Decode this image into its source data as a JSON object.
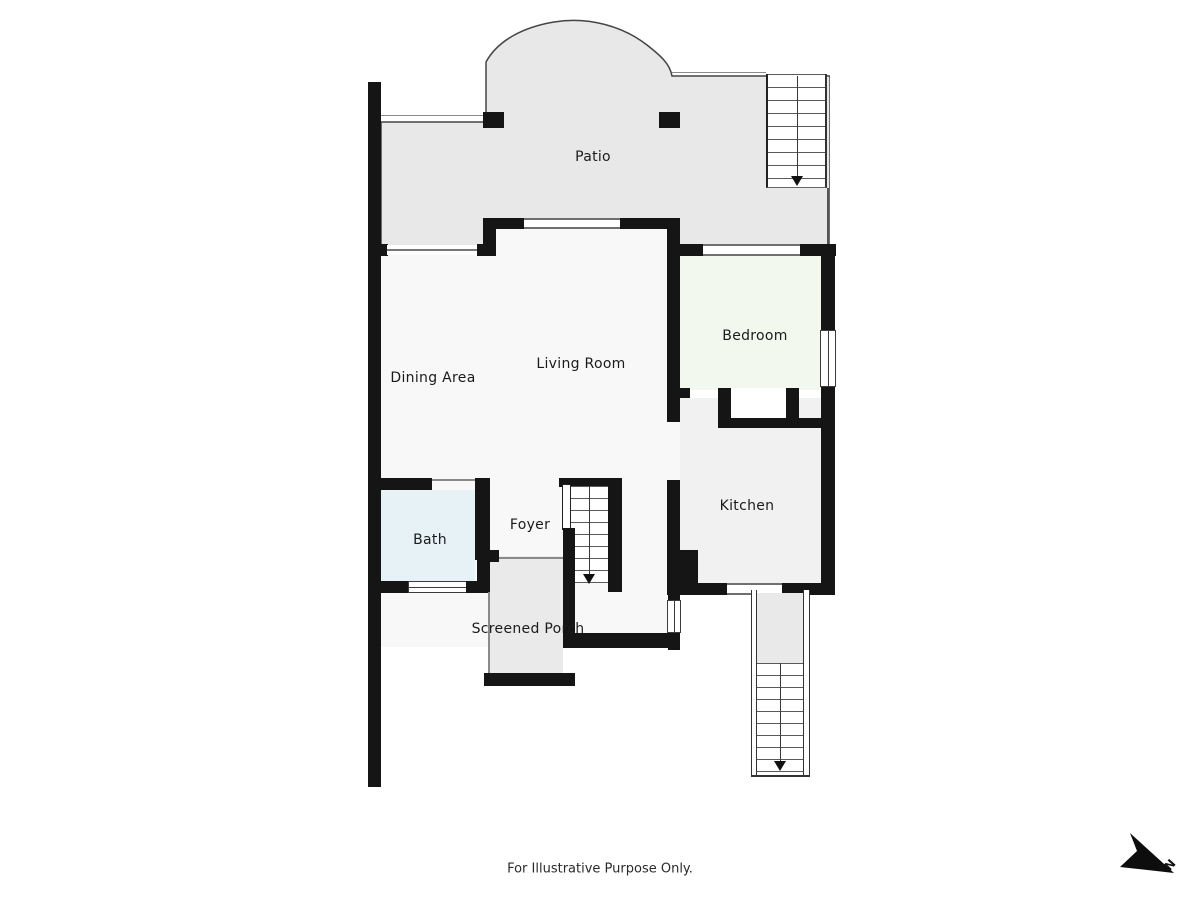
{
  "plan": {
    "rooms": {
      "patio": "Patio",
      "dining": "Dining Area",
      "living": "Living Room",
      "bedroom": "Bedroom",
      "kitchen": "Kitchen",
      "bath": "Bath",
      "foyer": "Foyer",
      "porch": "Screened Porch"
    },
    "compass": {
      "label": "N"
    },
    "footer": {
      "disclaimer": "For Illustrative Purpose Only."
    },
    "colors": {
      "wall": "#151515",
      "patio": "#e8e8e8",
      "floor": "#f8f8f8",
      "bedroom": "#f2f8ee",
      "kitchen": "#f1f1f1",
      "bath": "#e7f2f7",
      "porch": "#eaeaea",
      "stair_landing": "#e9e9e9",
      "outline": "#444444"
    }
  }
}
